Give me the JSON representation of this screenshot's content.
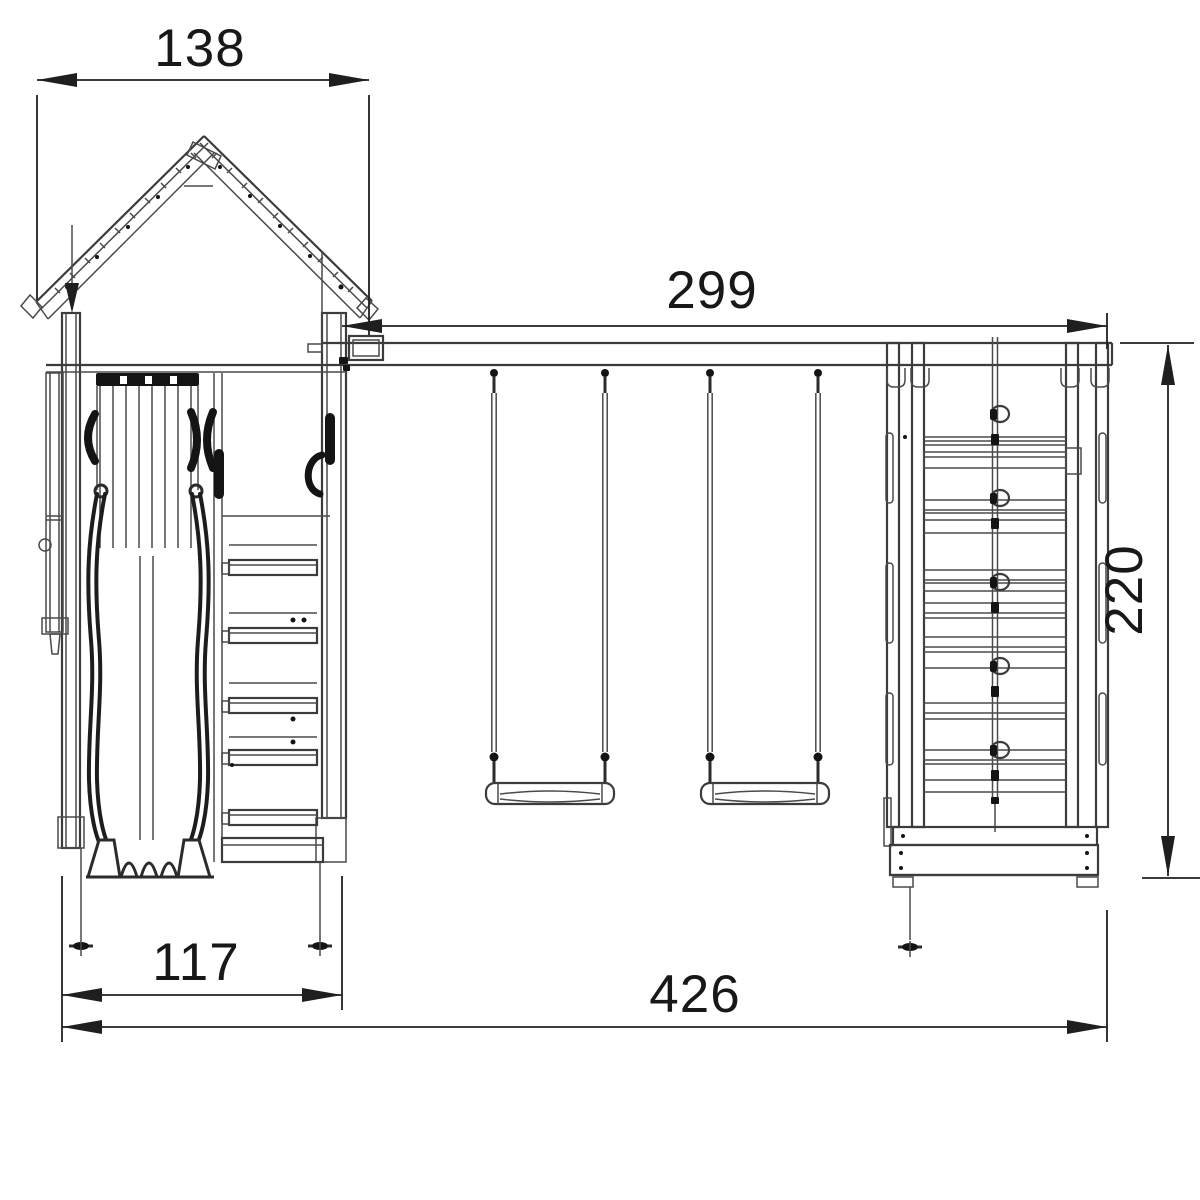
{
  "diagram": {
    "type": "technical-drawing",
    "subject": "playground-swing-set-front-elevation",
    "background_color": "#ffffff",
    "line_color": "#4a4a4a",
    "dark_color": "#141414",
    "dimension_color": "#1f1f1f",
    "dimensions": {
      "roof_width": "138",
      "beam_length": "299",
      "climb_wall_height": "220",
      "tower_width": "117",
      "total_width": "426"
    }
  }
}
